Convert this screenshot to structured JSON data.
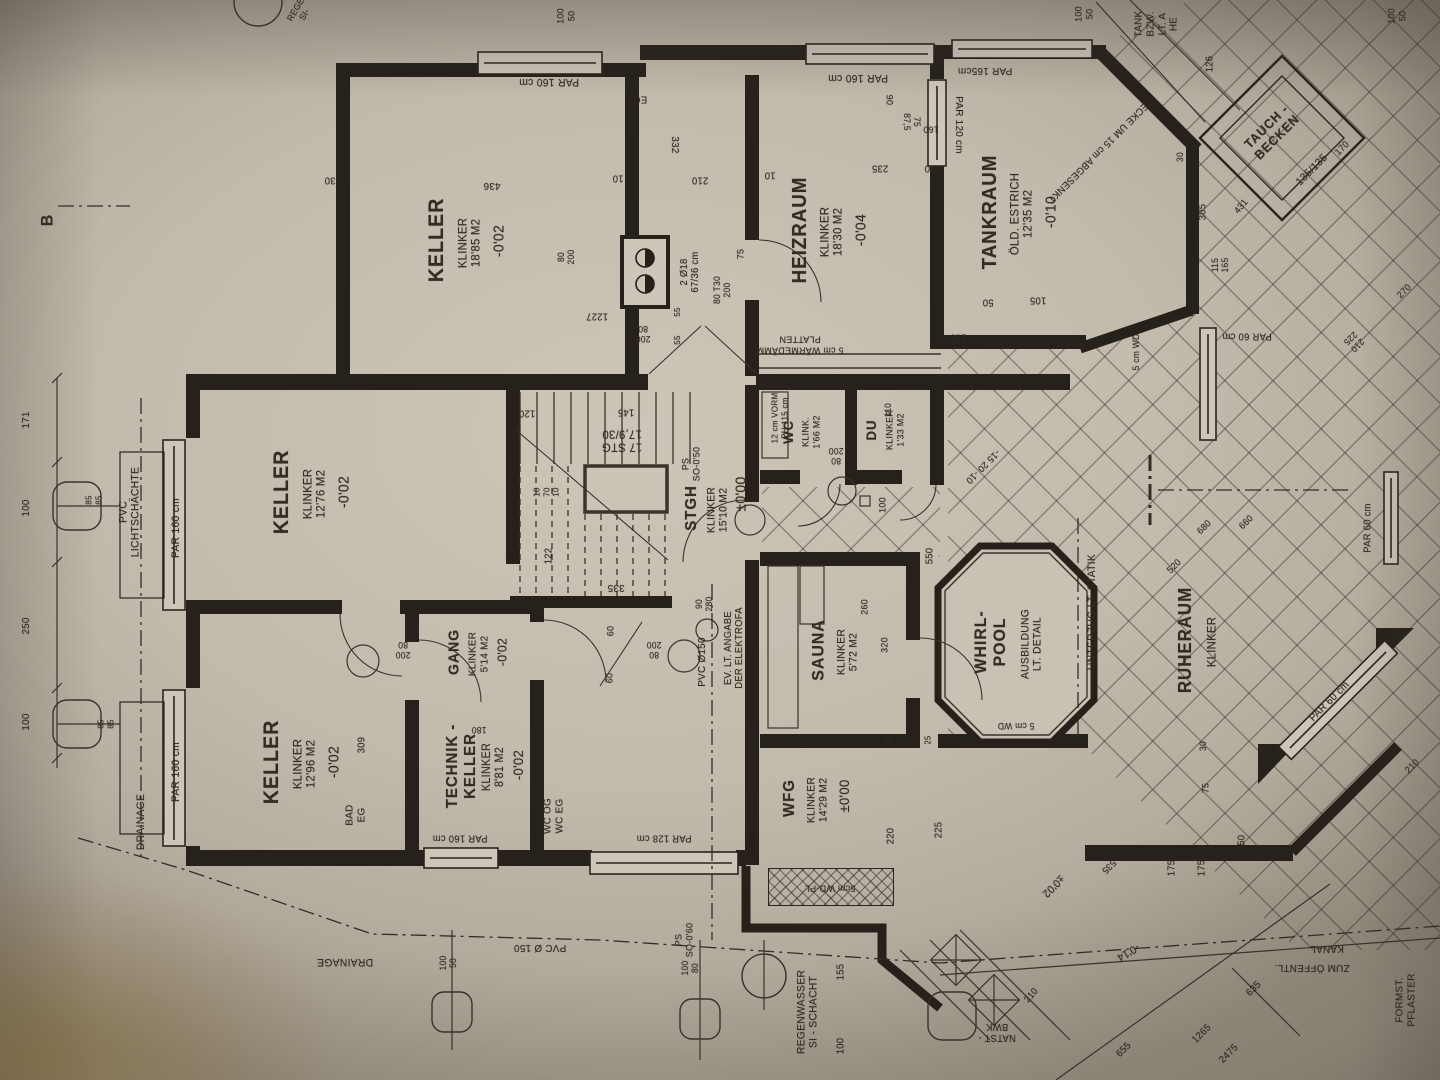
{
  "document": {
    "type": "architectural floor plan photo",
    "floor": "Kellergeschoss (basement plan)",
    "section_marker": "B",
    "ink_color": "#2b251e",
    "paper_color": "#c2bbad"
  },
  "rooms": [
    {
      "name": "KELLER",
      "finish": "KLINKER",
      "area": "18'85 M2",
      "level": "-0'02"
    },
    {
      "name": "HEIZRAUM",
      "finish": "KLINKER",
      "area": "18'30 M2",
      "level": "-0'04"
    },
    {
      "name": "TANKRAUM",
      "finish": "ÖLD. ESTRICH",
      "area": "12'35 M2",
      "level": "-0'10"
    },
    {
      "name": "KELLER",
      "finish": "KLINKER",
      "area": "12'76 M2",
      "level": "-0'02"
    },
    {
      "name": "KELLER",
      "finish": "KLINKER",
      "area": "12'96 M2",
      "level": "-0'02"
    },
    {
      "name": "TECHNIK-KELLER",
      "finish": "KLINKER",
      "area": "8'81 M2",
      "level": "-0'02"
    },
    {
      "name": "GANG",
      "finish": "KLINKER",
      "area": "5'14 M2",
      "level": "-0'02"
    },
    {
      "name": "STGH",
      "finish": "KLINKER",
      "area": "15'10 M2",
      "level": "±0'00",
      "note": "17 STG 17,9/30"
    },
    {
      "name": "WC",
      "finish": "KLINK.",
      "area": "1'66 M2"
    },
    {
      "name": "DU",
      "finish": "KLINKER",
      "area": "1'33 M2"
    },
    {
      "name": "SAUNA",
      "finish": "KLINKER",
      "area": "5'72 M2"
    },
    {
      "name": "WHIRL-POOL",
      "note": "AUSBILDUNG LT. DETAIL"
    },
    {
      "name": "RUHERAUM",
      "finish": "KLINKER"
    },
    {
      "name": "WFG",
      "finish": "KLINKER",
      "area": "14'29 M2",
      "level": "±0'00"
    },
    {
      "name": "TAUCH-BECKEN",
      "size": "135/135"
    }
  ],
  "labels": [
    {
      "t": "KELLER",
      "x": 437,
      "y": 240,
      "r": -90,
      "s": 21,
      "b": 1
    },
    {
      "t": "KLINKER\n18'85 M2",
      "x": 470,
      "y": 243,
      "r": -90,
      "s": 12
    },
    {
      "t": "-0'02",
      "x": 500,
      "y": 241,
      "r": -90,
      "s": 15
    },
    {
      "t": "HEIZRAUM",
      "x": 800,
      "y": 230,
      "r": -90,
      "s": 20,
      "b": 1
    },
    {
      "t": "KLINKER\n18'30 M2",
      "x": 832,
      "y": 232,
      "r": -90,
      "s": 12
    },
    {
      "t": "-0'04",
      "x": 862,
      "y": 230,
      "r": -90,
      "s": 15
    },
    {
      "t": "TANKRAUM",
      "x": 990,
      "y": 212,
      "r": -90,
      "s": 20,
      "b": 1
    },
    {
      "t": "ÖLD. ESTRICH\n12'35 M2",
      "x": 1022,
      "y": 214,
      "r": -90,
      "s": 12
    },
    {
      "t": "-0'10",
      "x": 1052,
      "y": 212,
      "r": -90,
      "s": 15
    },
    {
      "t": "KELLER",
      "x": 282,
      "y": 492,
      "r": -90,
      "s": 21,
      "b": 1
    },
    {
      "t": "KLINKER\n12'76 M2",
      "x": 315,
      "y": 494,
      "r": -90,
      "s": 12
    },
    {
      "t": "-0'02",
      "x": 345,
      "y": 492,
      "r": -90,
      "s": 15
    },
    {
      "t": "KELLER",
      "x": 272,
      "y": 762,
      "r": -90,
      "s": 21,
      "b": 1
    },
    {
      "t": "KLINKER\n12'96 M2",
      "x": 305,
      "y": 764,
      "r": -90,
      "s": 12
    },
    {
      "t": "-0'02",
      "x": 335,
      "y": 762,
      "r": -90,
      "s": 15
    },
    {
      "t": "TECHNIK -\nKELLER",
      "x": 462,
      "y": 766,
      "r": -90,
      "s": 16,
      "b": 1
    },
    {
      "t": "KLINKER\n8'81 M2",
      "x": 494,
      "y": 767,
      "r": -90,
      "s": 11.5
    },
    {
      "t": "-0'02",
      "x": 519,
      "y": 765,
      "r": -90,
      "s": 14
    },
    {
      "t": "GANG",
      "x": 455,
      "y": 652,
      "r": -90,
      "s": 15,
      "b": 1
    },
    {
      "t": "KLINKER\n5'14 M2",
      "x": 479,
      "y": 654,
      "r": -90,
      "s": 10.5
    },
    {
      "t": "-0'02",
      "x": 503,
      "y": 652,
      "r": -90,
      "s": 13
    },
    {
      "t": "STGH",
      "x": 692,
      "y": 508,
      "r": -90,
      "s": 16,
      "b": 1
    },
    {
      "t": "KLINKER\n15'10 M2",
      "x": 718,
      "y": 510,
      "r": -90,
      "s": 11
    },
    {
      "t": "±0'00",
      "x": 742,
      "y": 494,
      "r": -90,
      "s": 15
    },
    {
      "t": "WC",
      "x": 789,
      "y": 432,
      "r": -90,
      "s": 14,
      "b": 1
    },
    {
      "t": "KLINK.\n1'66 M2",
      "x": 812,
      "y": 432,
      "r": -90,
      "s": 9.5
    },
    {
      "t": "DU",
      "x": 872,
      "y": 430,
      "r": -90,
      "s": 14,
      "b": 1
    },
    {
      "t": "KLINKER\n1'33 M2",
      "x": 896,
      "y": 430,
      "r": -90,
      "s": 9.5
    },
    {
      "t": "SAUNA",
      "x": 818,
      "y": 650,
      "r": -90,
      "s": 17,
      "b": 1
    },
    {
      "t": "KLINKER\n5'72 M2",
      "x": 848,
      "y": 652,
      "r": -90,
      "s": 11
    },
    {
      "t": "WHIRL-\nPOOL",
      "x": 990,
      "y": 642,
      "r": -90,
      "s": 17,
      "b": 1
    },
    {
      "t": "AUSBILDUNG\nLT. DETAIL",
      "x": 1032,
      "y": 644,
      "r": -90,
      "s": 11
    },
    {
      "t": "RUHERAUM",
      "x": 1185,
      "y": 640,
      "r": -90,
      "s": 18,
      "b": 1
    },
    {
      "t": "KLINKER",
      "x": 1212,
      "y": 642,
      "r": -90,
      "s": 12
    },
    {
      "t": "WFG",
      "x": 790,
      "y": 798,
      "r": -90,
      "s": 16,
      "b": 1
    },
    {
      "t": "KLINKER\n14'29 M2",
      "x": 818,
      "y": 800,
      "r": -90,
      "s": 11
    },
    {
      "t": "±0'00",
      "x": 845,
      "y": 796,
      "r": -90,
      "s": 14
    },
    {
      "t": "TAUCH -\nBECKEN",
      "x": 1272,
      "y": 132,
      "r": -45,
      "s": 13,
      "b": 1
    },
    {
      "t": "135/135",
      "x": 1312,
      "y": 170,
      "r": -45,
      "s": 11
    },
    {
      "t": "2 Ø18\n67/36 cm",
      "x": 690,
      "y": 272,
      "r": -90,
      "s": 10
    },
    {
      "t": "DECKE UM 15 cm ABGESENKT",
      "x": 1100,
      "y": 150,
      "r": 135,
      "s": 10
    },
    {
      "t": "5 cm WÄRMEDÄMM\nPLATTEN",
      "x": 800,
      "y": 344,
      "r": 180,
      "s": 9.5
    },
    {
      "t": "12 cm VORM\nPH 115 cm",
      "x": 780,
      "y": 418,
      "r": -90,
      "s": 8.5
    },
    {
      "t": "PS\nSO-0'50",
      "x": 692,
      "y": 464,
      "r": -90,
      "s": 9.5
    },
    {
      "t": "17 STG\n17,9/30",
      "x": 622,
      "y": 440,
      "r": 180,
      "s": 12
    },
    {
      "t": "EV. LT. ANGABE\nDER ELEKTROFA",
      "x": 734,
      "y": 648,
      "r": -90,
      "s": 10
    },
    {
      "t": "PVC Ø150",
      "x": 703,
      "y": 662,
      "r": -90,
      "s": 10.5
    },
    {
      "t": "PVC Ø 150",
      "x": 540,
      "y": 947,
      "r": 180,
      "s": 10.5
    },
    {
      "t": "PS\nSO-0'60",
      "x": 685,
      "y": 940,
      "r": -90,
      "s": 9.5
    },
    {
      "t": "DRAINAGE",
      "x": 141,
      "y": 822,
      "r": -90,
      "s": 11
    },
    {
      "t": "DRAINAGE",
      "x": 345,
      "y": 962,
      "r": 180,
      "s": 11
    },
    {
      "t": "PVC\nLICHTSCHÄCHTE",
      "x": 130,
      "y": 512,
      "r": -90,
      "s": 11
    },
    {
      "t": "REGENWASSER\nSI - SCHACHT",
      "x": 808,
      "y": 1012,
      "r": -90,
      "s": 11
    },
    {
      "t": "5cm WD-PL",
      "x": 830,
      "y": 887,
      "r": 180,
      "s": 9.5
    },
    {
      "t": "5 cm WD",
      "x": 1136,
      "y": 352,
      "r": -90,
      "s": 9
    },
    {
      "t": "5 cm WD",
      "x": 1016,
      "y": 726,
      "r": 180,
      "s": 9
    },
    {
      "t": "UNTERZUG  LT. STATIK",
      "x": 1092,
      "y": 612,
      "r": -90,
      "s": 11
    },
    {
      "t": "ZUM ÖFFENTL.",
      "x": 1312,
      "y": 967,
      "r": 180,
      "s": 10.5
    },
    {
      "t": "KANAL",
      "x": 1327,
      "y": 948,
      "r": 180,
      "s": 10.5
    },
    {
      "t": "FORMST.\nPFLASTER",
      "x": 1406,
      "y": 1000,
      "r": -90,
      "s": 10.5
    },
    {
      "t": "NATST -\nBWK",
      "x": 997,
      "y": 1032,
      "r": 180,
      "s": 10
    },
    {
      "t": "TANK\nBZW.\nLT. A\nHE",
      "x": 1157,
      "y": 24,
      "r": -90,
      "s": 10.5
    },
    {
      "t": "B",
      "x": 47,
      "y": 220,
      "r": -90,
      "s": 17,
      "b": 1
    },
    {
      "t": "BAD\nEG",
      "x": 356,
      "y": 815,
      "r": -90,
      "s": 10.5
    },
    {
      "t": "WC OG\nWC EG",
      "x": 554,
      "y": 816,
      "r": -90,
      "s": 10.5
    },
    {
      "t": "EG",
      "x": 640,
      "y": 99,
      "r": 180,
      "s": 10
    },
    {
      "t": "REGE\nSI-",
      "x": 300,
      "y": 12,
      "r": -60,
      "s": 9
    },
    {
      "t": "PAR  160 cm",
      "x": 549,
      "y": 82,
      "r": 180,
      "s": 11
    },
    {
      "t": "PAR  160 cm",
      "x": 858,
      "y": 78,
      "r": 180,
      "s": 11
    },
    {
      "t": "PAR 165cm",
      "x": 985,
      "y": 70,
      "r": 180,
      "s": 10.5
    },
    {
      "t": "PAR  120 cm",
      "x": 958,
      "y": 125,
      "r": 90,
      "s": 10.5
    },
    {
      "t": "PAR  160 cm",
      "x": 176,
      "y": 528,
      "r": -90,
      "s": 11
    },
    {
      "t": "PAR  160 cm",
      "x": 176,
      "y": 772,
      "r": -90,
      "s": 11
    },
    {
      "t": "PAR 160 cm",
      "x": 460,
      "y": 838,
      "r": 180,
      "s": 10
    },
    {
      "t": "PAR 128 cm",
      "x": 664,
      "y": 838,
      "r": 180,
      "s": 10
    },
    {
      "t": "PAR 60 cm",
      "x": 1247,
      "y": 336,
      "r": 180,
      "s": 10
    },
    {
      "t": "PAR  60 cm",
      "x": 1368,
      "y": 528,
      "r": -90,
      "s": 10
    },
    {
      "t": "PAR  60 cm",
      "x": 1330,
      "y": 702,
      "r": -45,
      "s": 10.5
    },
    {
      "t": "100\n50",
      "x": 567,
      "y": 16,
      "r": -90,
      "s": 9.5
    },
    {
      "t": "100\n50",
      "x": 1085,
      "y": 14,
      "r": -90,
      "s": 9.5
    },
    {
      "t": "100\n50",
      "x": 1398,
      "y": 16,
      "r": -90,
      "s": 9.5
    },
    {
      "t": "126",
      "x": 1210,
      "y": 64,
      "r": -90,
      "s": 10
    },
    {
      "t": "436",
      "x": 492,
      "y": 185,
      "r": 180,
      "s": 10.5
    },
    {
      "t": "30",
      "x": 330,
      "y": 180,
      "r": 180,
      "s": 10
    },
    {
      "t": "10",
      "x": 618,
      "y": 178,
      "r": 180,
      "s": 10
    },
    {
      "t": "210",
      "x": 700,
      "y": 180,
      "r": 180,
      "s": 10
    },
    {
      "t": "332",
      "x": 674,
      "y": 145,
      "r": 90,
      "s": 10.5
    },
    {
      "t": "10",
      "x": 770,
      "y": 175,
      "r": 180,
      "s": 10
    },
    {
      "t": "235",
      "x": 880,
      "y": 168,
      "r": 180,
      "s": 10
    },
    {
      "t": "30",
      "x": 930,
      "y": 168,
      "r": 180,
      "s": 10
    },
    {
      "t": "90",
      "x": 888,
      "y": 100,
      "r": 90,
      "s": 9.5
    },
    {
      "t": "75\n87,5",
      "x": 912,
      "y": 122,
      "r": 90,
      "s": 9
    },
    {
      "t": "160",
      "x": 931,
      "y": 128,
      "r": 180,
      "s": 9.5
    },
    {
      "t": "305",
      "x": 1203,
      "y": 212,
      "r": -90,
      "s": 10
    },
    {
      "t": "105",
      "x": 1038,
      "y": 300,
      "r": 180,
      "s": 10
    },
    {
      "t": "50",
      "x": 988,
      "y": 302,
      "r": 180,
      "s": 10
    },
    {
      "t": "130",
      "x": 958,
      "y": 337,
      "r": 180,
      "s": 10
    },
    {
      "t": "115\n165",
      "x": 1220,
      "y": 265,
      "r": -90,
      "s": 9
    },
    {
      "t": "431",
      "x": 1242,
      "y": 207,
      "r": -50,
      "s": 9.5
    },
    {
      "t": "170",
      "x": 1343,
      "y": 149,
      "r": -45,
      "s": 9.5
    },
    {
      "t": "171",
      "x": 27,
      "y": 420,
      "r": -90,
      "s": 10.5
    },
    {
      "t": "100",
      "x": 27,
      "y": 508,
      "r": -90,
      "s": 10.5
    },
    {
      "t": "250",
      "x": 27,
      "y": 626,
      "r": -90,
      "s": 10.5
    },
    {
      "t": "100",
      "x": 27,
      "y": 722,
      "r": -90,
      "s": 10.5
    },
    {
      "t": "85\n85",
      "x": 94,
      "y": 500,
      "r": -90,
      "s": 8.5
    },
    {
      "t": "85\n85",
      "x": 106,
      "y": 724,
      "r": -90,
      "s": 8.5
    },
    {
      "t": "122",
      "x": 549,
      "y": 556,
      "r": -90,
      "s": 10
    },
    {
      "t": "120",
      "x": 527,
      "y": 413,
      "r": 180,
      "s": 10
    },
    {
      "t": "145",
      "x": 626,
      "y": 412,
      "r": 180,
      "s": 10
    },
    {
      "t": "10\n70\n10",
      "x": 547,
      "y": 492,
      "r": -90,
      "s": 8.5
    },
    {
      "t": "335",
      "x": 616,
      "y": 587,
      "r": 180,
      "s": 10.5
    },
    {
      "t": "60",
      "x": 612,
      "y": 631,
      "r": -90,
      "s": 9.5
    },
    {
      "t": "60",
      "x": 611,
      "y": 678,
      "r": -90,
      "s": 9.5
    },
    {
      "t": "80\n200",
      "x": 654,
      "y": 650,
      "r": 180,
      "s": 9
    },
    {
      "t": "90\n280",
      "x": 704,
      "y": 604,
      "r": -90,
      "s": 9
    },
    {
      "t": "80\n200",
      "x": 566,
      "y": 257,
      "r": -90,
      "s": 9
    },
    {
      "t": "1227",
      "x": 597,
      "y": 316,
      "r": 180,
      "s": 10
    },
    {
      "t": "200\n80",
      "x": 643,
      "y": 334,
      "r": 180,
      "s": 9
    },
    {
      "t": "55",
      "x": 678,
      "y": 312,
      "r": -90,
      "s": 8.5
    },
    {
      "t": "55",
      "x": 678,
      "y": 340,
      "r": -90,
      "s": 8.5
    },
    {
      "t": "75",
      "x": 742,
      "y": 254,
      "r": -90,
      "s": 9.5
    },
    {
      "t": "80 T30\n200",
      "x": 722,
      "y": 290,
      "r": -90,
      "s": 9
    },
    {
      "t": "80\n200",
      "x": 836,
      "y": 456,
      "r": 180,
      "s": 9
    },
    {
      "t": "110",
      "x": 888,
      "y": 410,
      "r": -90,
      "s": 9
    },
    {
      "t": "100",
      "x": 884,
      "y": 505,
      "r": -90,
      "s": 9.5
    },
    {
      "t": "550",
      "x": 930,
      "y": 556,
      "r": -90,
      "s": 10
    },
    {
      "t": "-15 20 -10",
      "x": 982,
      "y": 466,
      "r": 135,
      "s": 9.5
    },
    {
      "t": "260",
      "x": 866,
      "y": 607,
      "r": -90,
      "s": 9.5
    },
    {
      "t": "320",
      "x": 886,
      "y": 645,
      "r": -90,
      "s": 9.5
    },
    {
      "t": "25",
      "x": 889,
      "y": 740,
      "r": -90,
      "s": 8
    },
    {
      "t": "25",
      "x": 929,
      "y": 740,
      "r": -90,
      "s": 8
    },
    {
      "t": "220",
      "x": 891,
      "y": 836,
      "r": -90,
      "s": 10
    },
    {
      "t": "225",
      "x": 939,
      "y": 830,
      "r": -90,
      "s": 10
    },
    {
      "t": "155",
      "x": 841,
      "y": 972,
      "r": -90,
      "s": 10
    },
    {
      "t": "100",
      "x": 841,
      "y": 1046,
      "r": -90,
      "s": 10
    },
    {
      "t": "100\n50",
      "x": 448,
      "y": 963,
      "r": -90,
      "s": 9
    },
    {
      "t": "100\n80",
      "x": 690,
      "y": 968,
      "r": -90,
      "s": 9
    },
    {
      "t": "210",
      "x": 1032,
      "y": 996,
      "r": -50,
      "s": 9.5
    },
    {
      "t": "535",
      "x": 1108,
      "y": 866,
      "r": 135,
      "s": 9.5
    },
    {
      "t": "175",
      "x": 1172,
      "y": 868,
      "r": -90,
      "s": 10
    },
    {
      "t": "175",
      "x": 1202,
      "y": 868,
      "r": -90,
      "s": 10
    },
    {
      "t": "250",
      "x": 1242,
      "y": 843,
      "r": -90,
      "s": 10
    },
    {
      "t": "75",
      "x": 1207,
      "y": 788,
      "r": -90,
      "s": 9.5
    },
    {
      "t": "±0'02",
      "x": 1053,
      "y": 886,
      "r": 135,
      "s": 11
    },
    {
      "t": "-0'14",
      "x": 1128,
      "y": 952,
      "r": 150,
      "s": 11
    },
    {
      "t": "635",
      "x": 1254,
      "y": 989,
      "r": -45,
      "s": 10
    },
    {
      "t": "1265",
      "x": 1202,
      "y": 1034,
      "r": -45,
      "s": 10
    },
    {
      "t": "2475",
      "x": 1229,
      "y": 1054,
      "r": -45,
      "s": 10
    },
    {
      "t": "655",
      "x": 1124,
      "y": 1050,
      "r": -45,
      "s": 10
    },
    {
      "t": "210",
      "x": 1413,
      "y": 767,
      "r": -45,
      "s": 9.5
    },
    {
      "t": "210\n225",
      "x": 1354,
      "y": 342,
      "r": 135,
      "s": 9
    },
    {
      "t": "270",
      "x": 1405,
      "y": 292,
      "r": -45,
      "s": 9.5
    },
    {
      "t": "680",
      "x": 1205,
      "y": 528,
      "r": -45,
      "s": 9.5
    },
    {
      "t": "660",
      "x": 1247,
      "y": 523,
      "r": -45,
      "s": 9.5
    },
    {
      "t": "520",
      "x": 1175,
      "y": 567,
      "r": -45,
      "s": 9.5
    },
    {
      "t": "30",
      "x": 1203,
      "y": 746,
      "r": -90,
      "s": 9
    },
    {
      "t": "30",
      "x": 1180,
      "y": 157,
      "r": -90,
      "s": 9
    },
    {
      "t": "309",
      "x": 362,
      "y": 745,
      "r": -90,
      "s": 10
    },
    {
      "t": "180",
      "x": 479,
      "y": 730,
      "r": 180,
      "s": 9
    },
    {
      "t": "200\n80",
      "x": 403,
      "y": 650,
      "r": 180,
      "s": 9
    }
  ]
}
